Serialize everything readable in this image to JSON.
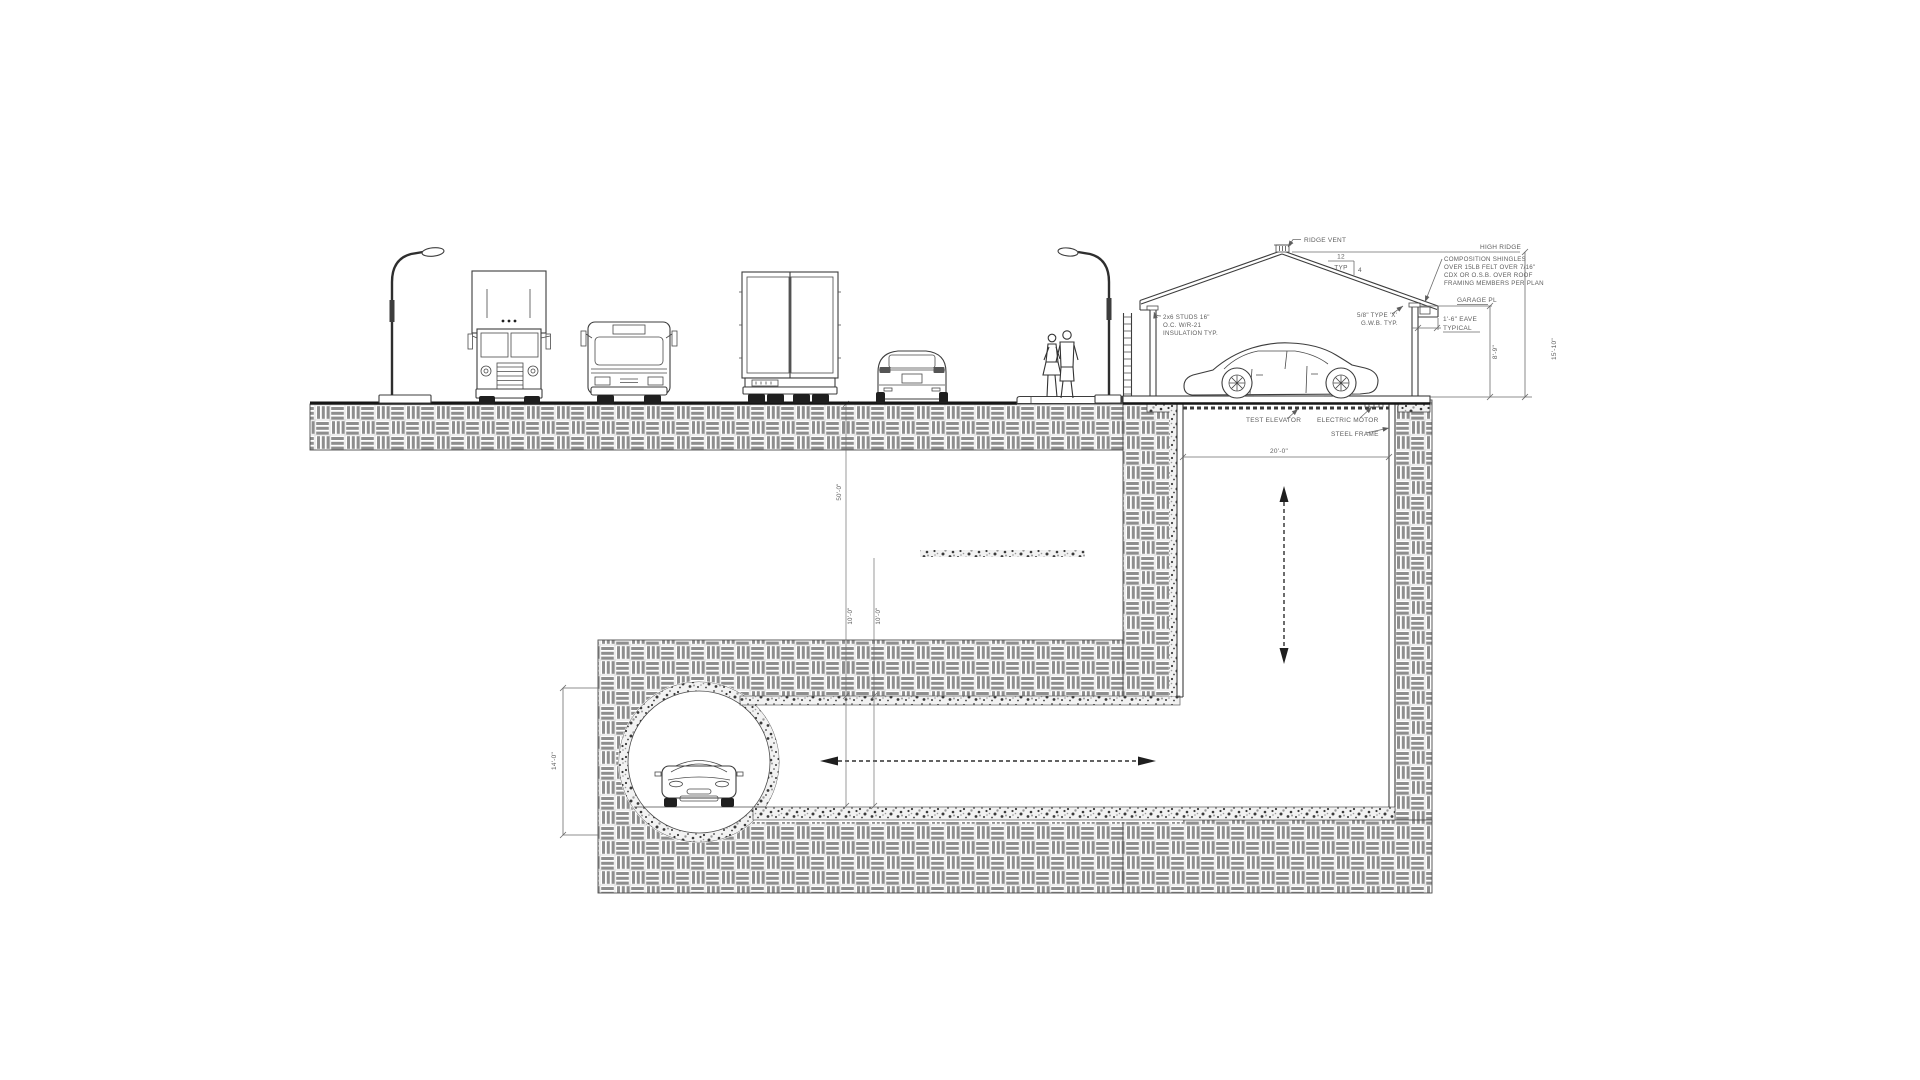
{
  "colors": {
    "background": "#ffffff",
    "line": "#3d3d3d",
    "hatch": "#8e8e8e",
    "text": "#5e5e5e"
  },
  "drawing": {
    "annotations": {
      "ridge_vent": "RIDGE VENT",
      "high_ridge": "HIGH RIDGE",
      "comp_l1": "COMPOSITION SHINGLES",
      "comp_l2": "OVER 15LB FELT OVER 7/16\"",
      "comp_l3": "CDX OR O.S.B. OVER ROOF",
      "comp_l4": "FRAMING MEMBERS PER PLAN",
      "pitch_run": "12",
      "pitch_typ": "TYP",
      "pitch_rise": "4",
      "garage_plate": "GARAGE PL",
      "eave_l1": "1'-6\" EAVE",
      "eave_l2": "TYPICAL",
      "studs_l1": "2x6 STUDS 16\"",
      "studs_l2": "O.C. W/R-21",
      "studs_l3": "INSULATION TYP.",
      "gwb_l1": "5/8\" TYPE 'X'",
      "gwb_l2": "G.W.B. TYP.",
      "test_elevator": "TEST ELEVATOR",
      "electric_motor": "ELECTRIC MOTOR",
      "steel_frame": "STEEL FRAME"
    },
    "dimensions": {
      "ridge_height": "15'-10\"",
      "plate_height": "8'-9\"",
      "shaft_width": "20'-0\"",
      "tunnel_diameter": "14'-0\"",
      "tunnel_depth": "50'-0\"",
      "dim_small_1": "10'-0\"",
      "dim_small_2": "10'-0\""
    }
  }
}
